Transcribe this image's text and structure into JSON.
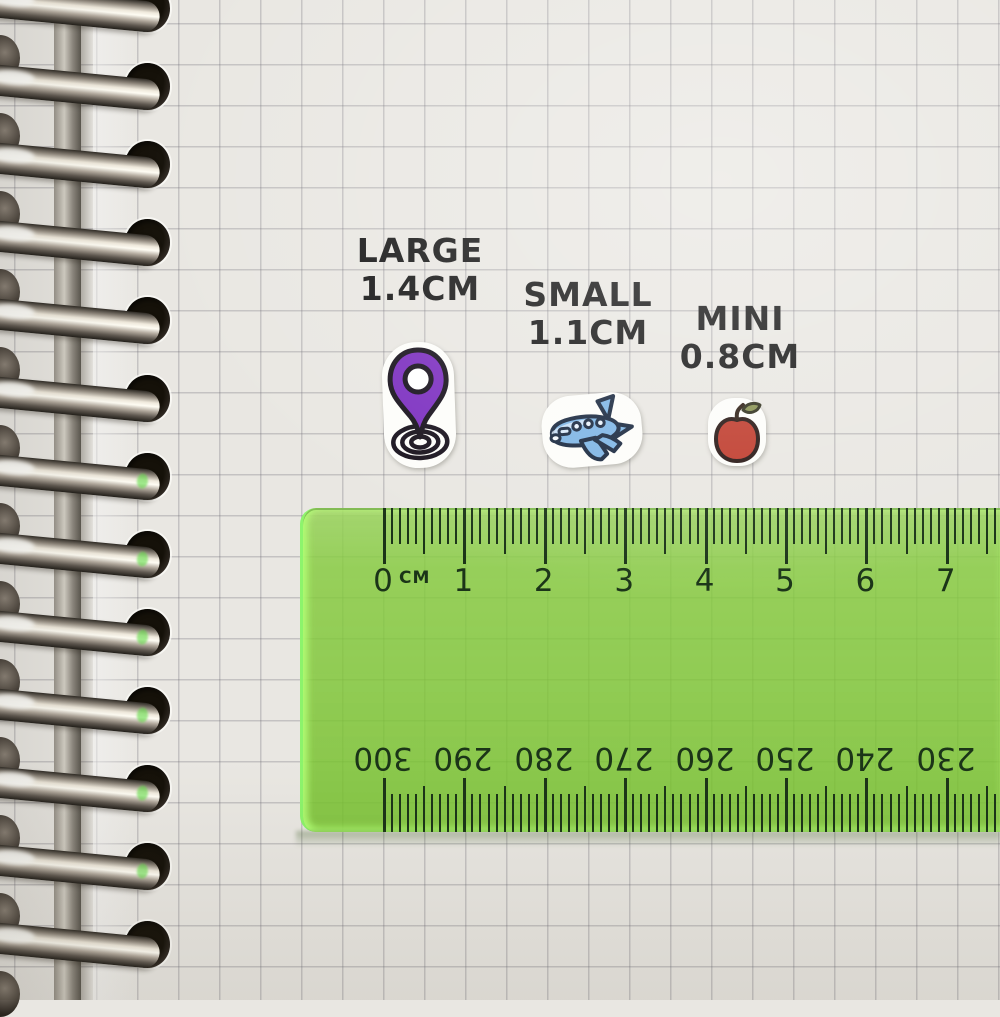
{
  "size_labels": [
    {
      "id": "large",
      "title": "LARGE",
      "size": "1.4CM"
    },
    {
      "id": "small",
      "title": "SMALL",
      "size": "1.1CM"
    },
    {
      "id": "mini",
      "title": "MINI",
      "size": "0.8CM"
    }
  ],
  "stickers": [
    {
      "name": "location-pin-sticker",
      "colors": {
        "pin": "#7c2fc0",
        "inner": "#ffffff",
        "outline": "#17111c"
      }
    },
    {
      "name": "airplane-sticker",
      "colors": {
        "body": "#7db4e4",
        "light": "#d9eafa",
        "outline": "#17263d"
      }
    },
    {
      "name": "apple-sticker",
      "colors": {
        "fruit": "#bf3a2b",
        "leaf": "#87914f",
        "stem": "#2a1a10"
      }
    }
  ],
  "ruler": {
    "unit_label": "CM",
    "top_numbers": [
      "0",
      "1",
      "2",
      "3",
      "4",
      "5",
      "6",
      "7"
    ],
    "bottom_numbers": [
      "300",
      "290",
      "280",
      "270",
      "260",
      "250",
      "240",
      "230"
    ],
    "body_color": "#7cc432",
    "tick_color": "#1b3418"
  },
  "notebook": {
    "paper_color": "#e9e7e2",
    "grid_line_color": "#b9b8b4",
    "binding": "spiral-metal"
  }
}
